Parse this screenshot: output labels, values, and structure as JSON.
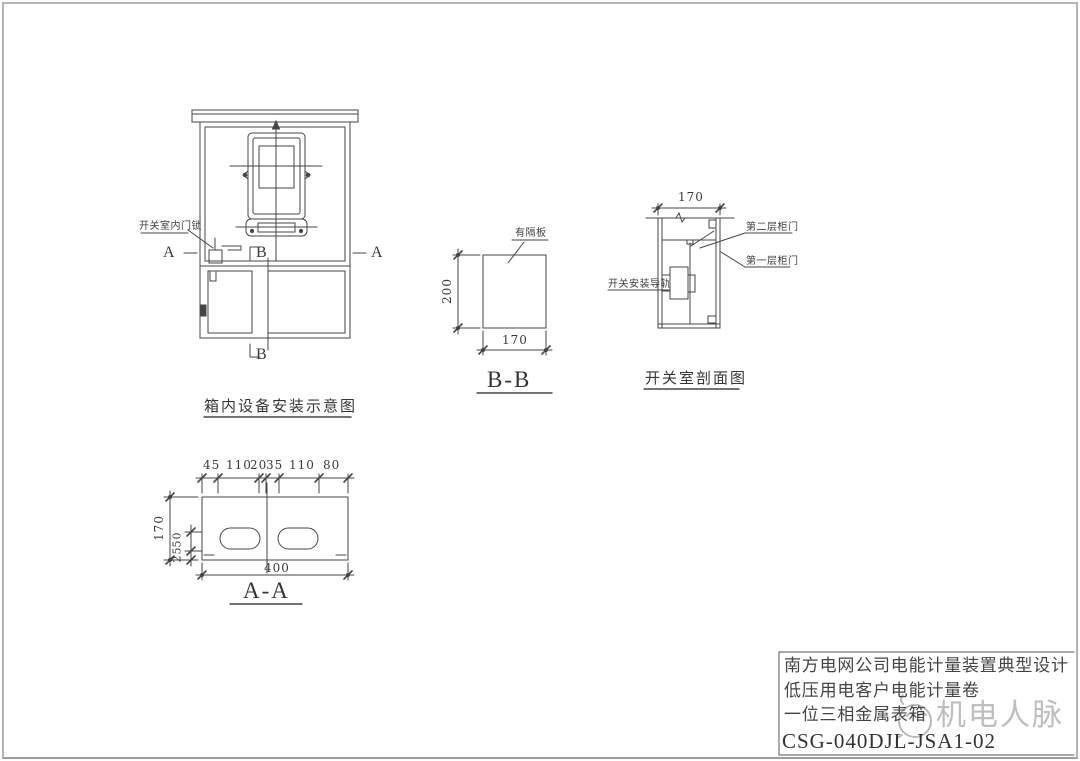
{
  "sheet": {
    "views": {
      "cabinet_front": {
        "title": "箱内设备安装示意图",
        "labels": {
          "door_lock": "开关室内门锁",
          "section_a": "A",
          "section_b": "B"
        }
      },
      "section_bb": {
        "title": "B-B",
        "partition_label": "有隔板",
        "dim_height": "200",
        "dim_width": "170"
      },
      "switch_room_section": {
        "title": "开关室剖面图",
        "dim_width": "170",
        "door_layer2_label": "第二层柜门",
        "door_layer1_label": "第一层柜门",
        "rail_label": "开关安装导轨"
      },
      "section_aa": {
        "title": "A-A",
        "dims_top": [
          "45",
          "110",
          "20",
          "35",
          "110",
          "80"
        ],
        "dim_total_width": "400",
        "dim_height": "170",
        "dim_slot_offsets": [
          "50",
          "25"
        ]
      }
    },
    "title_block": {
      "row1": "南方电网公司电能计量装置典型设计",
      "row2": "低压用电客户电能计量卷",
      "row3": "一位三相金属表箱",
      "drawing_number": "CSG-040DJL-JSA1-02"
    },
    "watermark": {
      "text": "机电人脉"
    },
    "colors": {
      "line": "#454545",
      "watermark": "#a9a9a9"
    }
  }
}
